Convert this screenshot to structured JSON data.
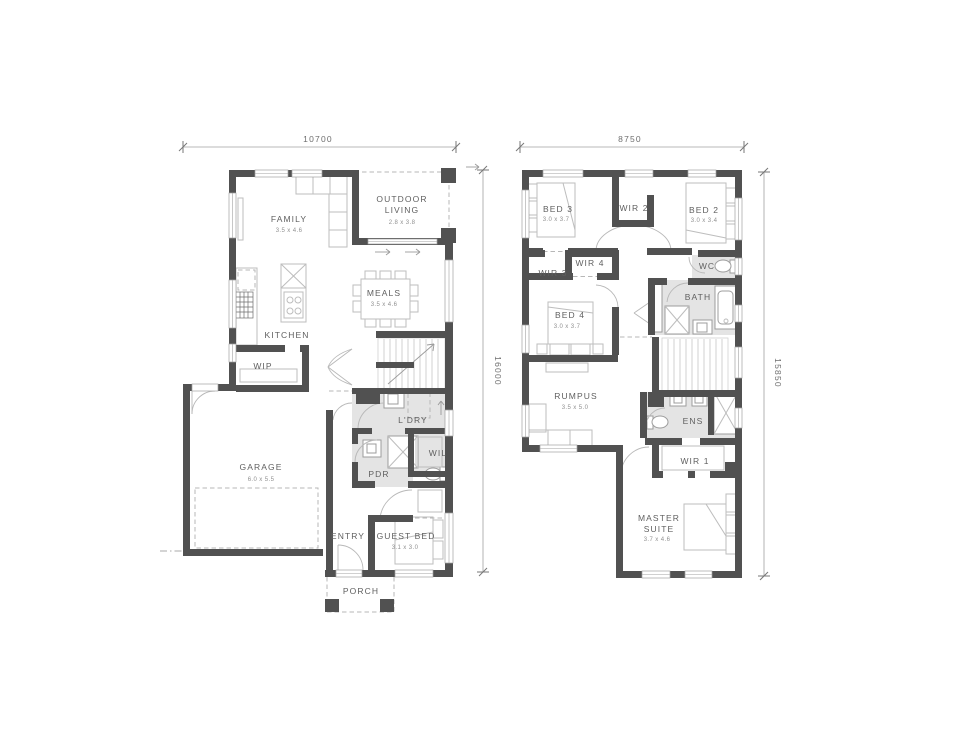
{
  "ground": {
    "dim_width": "10700",
    "dim_height": "16000",
    "rooms": {
      "family": {
        "name": "FAMILY",
        "size": "3.5 x 4.6"
      },
      "outdoor_living": {
        "name_line1": "OUTDOOR",
        "name_line2": "LIVING",
        "size": "2.8 x 3.8"
      },
      "meals": {
        "name": "MEALS",
        "size": "3.5 x 4.6"
      },
      "kitchen": {
        "name": "KITCHEN"
      },
      "wip": {
        "name": "WIP"
      },
      "garage": {
        "name": "GARAGE",
        "size": "6.0 x 5.5"
      },
      "laundry": {
        "name": "L'DRY"
      },
      "wil": {
        "name": "WIL"
      },
      "pdr": {
        "name": "PDR"
      },
      "entry": {
        "name": "ENTRY"
      },
      "guest_bed": {
        "name": "GUEST BED",
        "size": "3.1 x 3.0"
      },
      "porch": {
        "name": "PORCH"
      }
    }
  },
  "upper": {
    "dim_width": "8750",
    "dim_height": "15850",
    "rooms": {
      "bed3": {
        "name": "BED 3",
        "size": "3.0 x 3.7"
      },
      "wir2": {
        "name": "WIR 2"
      },
      "bed2": {
        "name": "BED 2",
        "size": "3.0 x 3.4"
      },
      "wir3": {
        "name": "WIR 3"
      },
      "wir4": {
        "name": "WIR 4"
      },
      "wc": {
        "name": "WC"
      },
      "bath": {
        "name": "BATH"
      },
      "bed4": {
        "name": "BED 4",
        "size": "3.0 x 3.7"
      },
      "rumpus": {
        "name": "RUMPUS",
        "size": "3.5 x 5.0"
      },
      "ens": {
        "name": "ENS"
      },
      "wir1": {
        "name": "WIR 1"
      },
      "master_suite": {
        "name_line1": "MASTER",
        "name_line2": "SUITE",
        "size": "3.7 x 4.6"
      }
    }
  },
  "colors": {
    "wall": "#515151",
    "wet_area": "#e4e4e4",
    "fixture_stroke": "#bdbdbd",
    "text": "#5f5f5f",
    "dim_text": "#6e6e6e"
  }
}
